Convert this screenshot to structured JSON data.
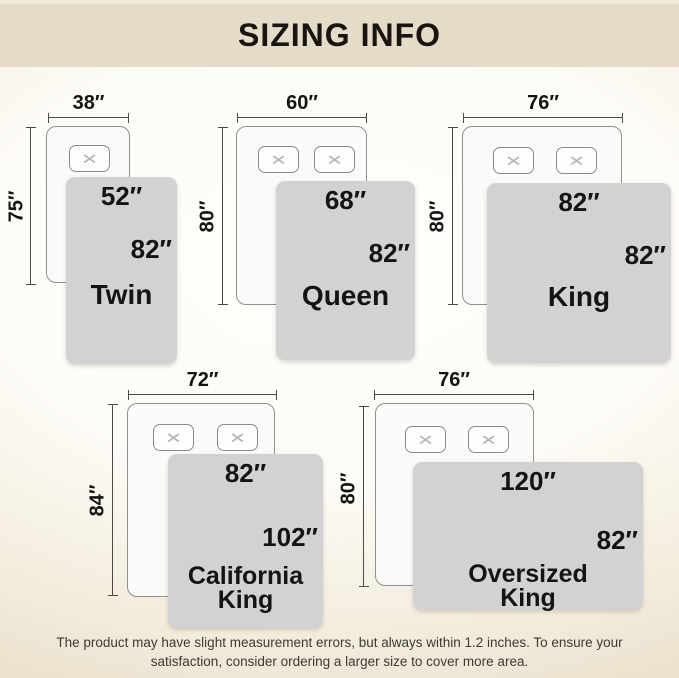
{
  "header": {
    "title": "SIZING INFO"
  },
  "icons": {
    "pillow_x": "✕"
  },
  "colors": {
    "header_band": "#e5dbc9",
    "background_tan": "#e7dcc8",
    "blanket_gray": "#d2d2d3",
    "text": "#141414",
    "dimension_line": "#4a4a4a"
  },
  "diagrams": [
    {
      "name": "Twin",
      "mattress_width": "38″",
      "mattress_height": "75″",
      "blanket_width": "52″",
      "blanket_height": "82″",
      "pillows": 1
    },
    {
      "name": "Queen",
      "mattress_width": "60″",
      "mattress_height": "80″",
      "blanket_width": "68″",
      "blanket_height": "82″",
      "pillows": 2
    },
    {
      "name": "King",
      "mattress_width": "76″",
      "mattress_height": "80″",
      "blanket_width": "82″",
      "blanket_height": "82″",
      "pillows": 2
    },
    {
      "name": "California King",
      "mattress_width": "72″",
      "mattress_height": "84″",
      "blanket_width": "82″",
      "blanket_height": "102″",
      "pillows": 2
    },
    {
      "name": "Oversized King",
      "mattress_width": "76″",
      "mattress_height": "80″",
      "blanket_width": "120″",
      "blanket_height": "82″",
      "pillows": 2
    }
  ],
  "footer": {
    "line1": "The product may have slight measurement errors, but always within 1.2 inches. To ensure your",
    "line2": "satisfaction, consider ordering a larger size to cover more area."
  }
}
